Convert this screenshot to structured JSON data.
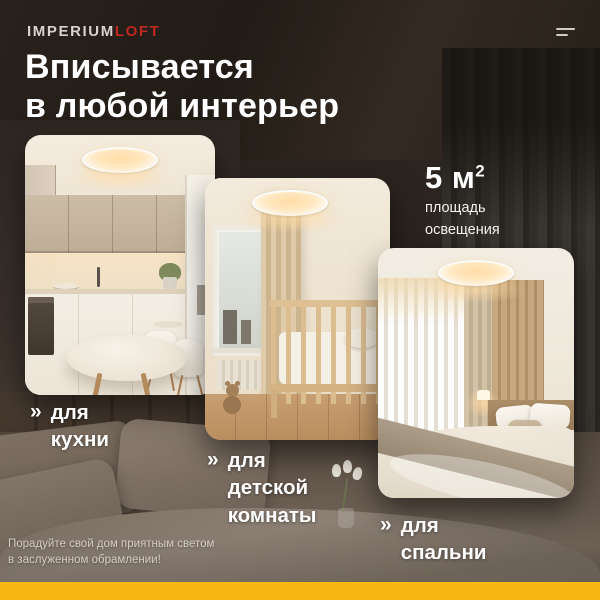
{
  "brand": {
    "name_primary": "IMPERIUM",
    "name_accent": "LOFT"
  },
  "headline": {
    "line1": "Вписывается",
    "line2": "в любой интерьер"
  },
  "stat": {
    "value": "5 м",
    "sup": "2",
    "caption_line1": "площадь",
    "caption_line2": "освещения"
  },
  "cards": [
    {
      "id": "kitchen",
      "label_prefix": "»",
      "label_lines": [
        "для",
        "кухни"
      ]
    },
    {
      "id": "kids-room",
      "label_prefix": "»",
      "label_lines": [
        "для",
        "детской",
        "комнаты"
      ]
    },
    {
      "id": "bedroom",
      "label_prefix": "»",
      "label_lines": [
        "для",
        "спальни"
      ]
    }
  ],
  "footer": {
    "note_line1": "Порадуйте свой дом приятным светом",
    "note_line2": "в заслуженном обрамлении!"
  },
  "colors": {
    "background": "#2b2420",
    "bottom_bar": "#F8B713",
    "accent_red": "#BF2721",
    "text": "#FFFFFF"
  }
}
